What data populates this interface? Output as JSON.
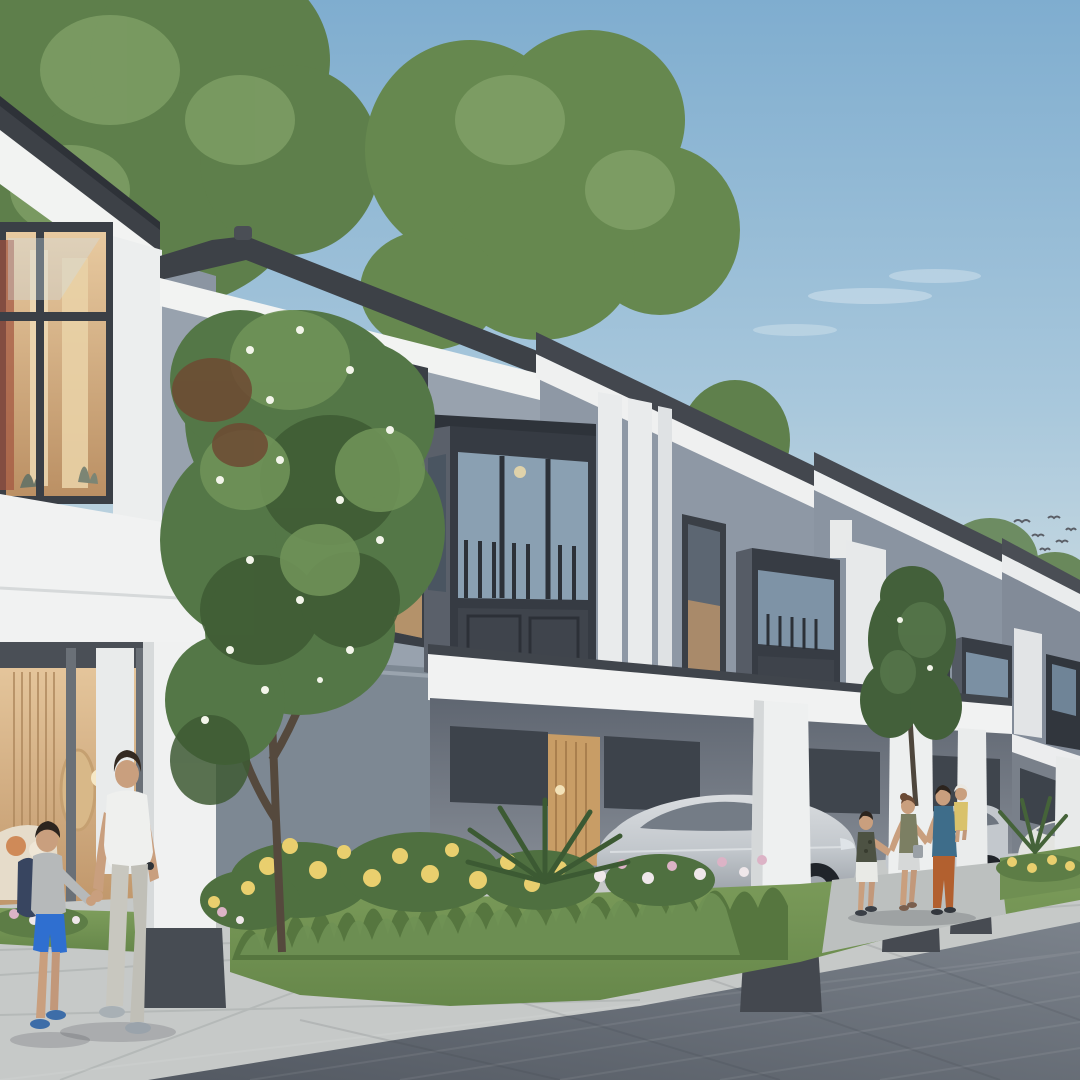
{
  "meta": {
    "title": "Modern two-storey townhouse row — architectural rendering",
    "description": "Daylight architectural rendering of a row of modern two-storey grey-and-white townhouses with dark bay windows, carports sheltering silver sedans, a flowering garden bed with yellow roses, a paved street, a father walking with his son in the foreground and a family of four strolling further along; green trees behind the roofs and birds in a pale blue sky.",
    "type": "architectural-rendering",
    "time_of_day": "day"
  },
  "palette": {
    "skyTop": "#7fadcf",
    "skyMid": "#a9c8dc",
    "skyLow": "#e9e6df",
    "cloud": "#ffffff",
    "roof": "#3d4147",
    "fascia": "#f2f3f2",
    "wall": "#98a2ae",
    "wallFar": "#8a94a1",
    "wallSide": "#8b95a2",
    "gardenWall": "#7d8893",
    "frame": "#3a3f46",
    "bayFront": "#363b43",
    "baySide": "#5a606a",
    "glass": "#8aa0b2",
    "glassDark": "#454e59",
    "interior": "#e0bd8c",
    "glow": "#f6e8c6",
    "pillar": "#f0f1f1",
    "pillarBase": "#474c53",
    "beam": "#f1f2f2",
    "treeDark": "#3e5a34",
    "treeMid": "#547747",
    "treeLight": "#6f9258",
    "treeBrown": "#6e4a33",
    "blossom": "#f3f5ea",
    "trunk": "#55493d",
    "bgTree": "#5e7f4b",
    "bgTreeLight": "#7fa066",
    "grass": "#78985a",
    "grassDark": "#56763f",
    "gardenGreen": "#4f7040",
    "flowerYellow": "#e9cf6e",
    "flowerPink": "#dcb3c6",
    "flowerWhite": "#efe7ea",
    "pavement": "#c6c9c8",
    "road": "#5d646d",
    "roadFar": "#7b828b",
    "driveway": "#bcc0bf",
    "carSilver": "#cbcfd3",
    "carShadow": "#9aa0a7",
    "carGlass": "#747c86",
    "carWhite": "#e3e4e0",
    "wheel": "#20242a",
    "alloy": "#a0a6ad",
    "skin": "#c99f7e",
    "hairDark": "#342a22",
    "tshirtWhite": "#eff0ee",
    "pantsLight": "#c8c7bf",
    "shoeGray": "#a8b0b5",
    "boyTop": "#b6b9ba",
    "boyShorts": "#2f6fd0",
    "backpack": "#384560",
    "boyShoes": "#3d6da8",
    "womanTop": "#7c7f63",
    "womanShorts": "#d6d8d8",
    "womanHair": "#6b4a35",
    "manTee": "#3e6d8a",
    "manPants": "#b2602f",
    "toddlerOutfit": "#d9c26b",
    "cap": "#eae8e2",
    "boy2Top": "#4d5243",
    "boy2Shorts": "#e9eae6",
    "birds": "#5a5e66"
  },
  "scene": {
    "houses": {
      "count_visible": 5,
      "style": "two-storey modern townhouses, grey-blue walls, white fascias and pillars, charcoal hip roofs, dark charcoal bay-window boxes with balustrades",
      "features": [
        "carports with white square pillars",
        "warm lit interiors visible through glazing",
        "white pilaster columns between units"
      ]
    },
    "vehicles": [
      {
        "type": "silver sedan",
        "location": "carport centre"
      },
      {
        "type": "silver sedan",
        "location": "carport right of pillar"
      },
      {
        "type": "white sedan",
        "location": "far carport at right"
      }
    ],
    "people": [
      {
        "who": "father",
        "clothes": "white t-shirt, light grey trousers"
      },
      {
        "who": "son",
        "clothes": "grey sweatshirt, blue shorts, navy backpack"
      },
      {
        "who": "boy",
        "clothes": "dark camo tee, white shorts"
      },
      {
        "who": "mother",
        "clothes": "olive tank top, white shorts, shoulder bag"
      },
      {
        "who": "father-2",
        "clothes": "blue tee, rust-orange trousers, carrying toddler"
      },
      {
        "who": "toddler",
        "clothes": "yellow outfit, white cap"
      }
    ],
    "vegetation": [
      "large flowering tree with white blossoms",
      "slender tree near family",
      "garden bed of yellow roses, pink and white flowers, tall grasses",
      "cycad/palm shrubs",
      "background tree canopies"
    ],
    "sky": {
      "birds": 6,
      "clouds": "thin wisps",
      "gradient": "blue to warm pale horizon"
    }
  }
}
